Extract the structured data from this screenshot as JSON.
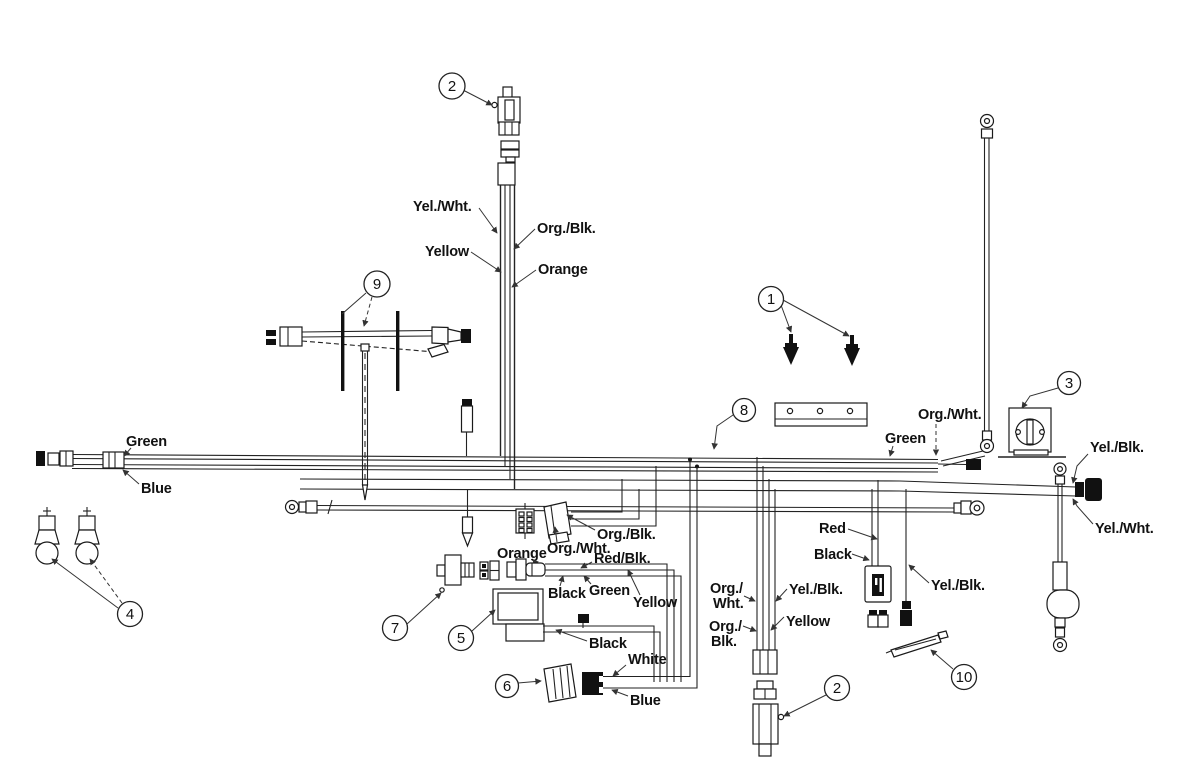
{
  "diagram": {
    "type": "wiring-harness-parts-diagram",
    "callouts": {
      "c1": "1",
      "c2": "2",
      "c3": "3",
      "c4": "4",
      "c5": "5",
      "c6": "6",
      "c7": "7",
      "c8": "8",
      "c9": "9",
      "c10": "10"
    },
    "labels": {
      "top_yel_wht": "Yel./Wht.",
      "top_org_blk": "Org./Blk.",
      "top_yellow": "Yellow",
      "top_orange": "Orange",
      "left_green": "Green",
      "left_blue": "Blue",
      "harness_org_wht": "Org./Wht.",
      "harness_green": "Green",
      "plug_yel_blk": "Yel./Blk.",
      "plug_yel_wht": "Yel./Wht.",
      "mid_org_blk": "Org./Blk.",
      "mid_org_wht": "Org./Wht.",
      "mid_orange": "Orange",
      "mid_red_blk": "Red/Blk.",
      "mid_black": "Black",
      "mid_green": "Green",
      "mid_yellow": "Yellow",
      "module_black": "Black",
      "conn6_white": "White",
      "conn6_blue": "Blue",
      "eng_org_wht_l1": "Org./",
      "eng_org_wht_l2": "Wht.",
      "eng_org_blk_l1": "Org./",
      "eng_org_blk_l2": "Blk.",
      "eng_yel_blk": "Yel./Blk.",
      "eng_yellow": "Yellow",
      "fuse_red": "Red",
      "fuse_black": "Black",
      "diode_yel_blk": "Yel./Blk."
    }
  }
}
